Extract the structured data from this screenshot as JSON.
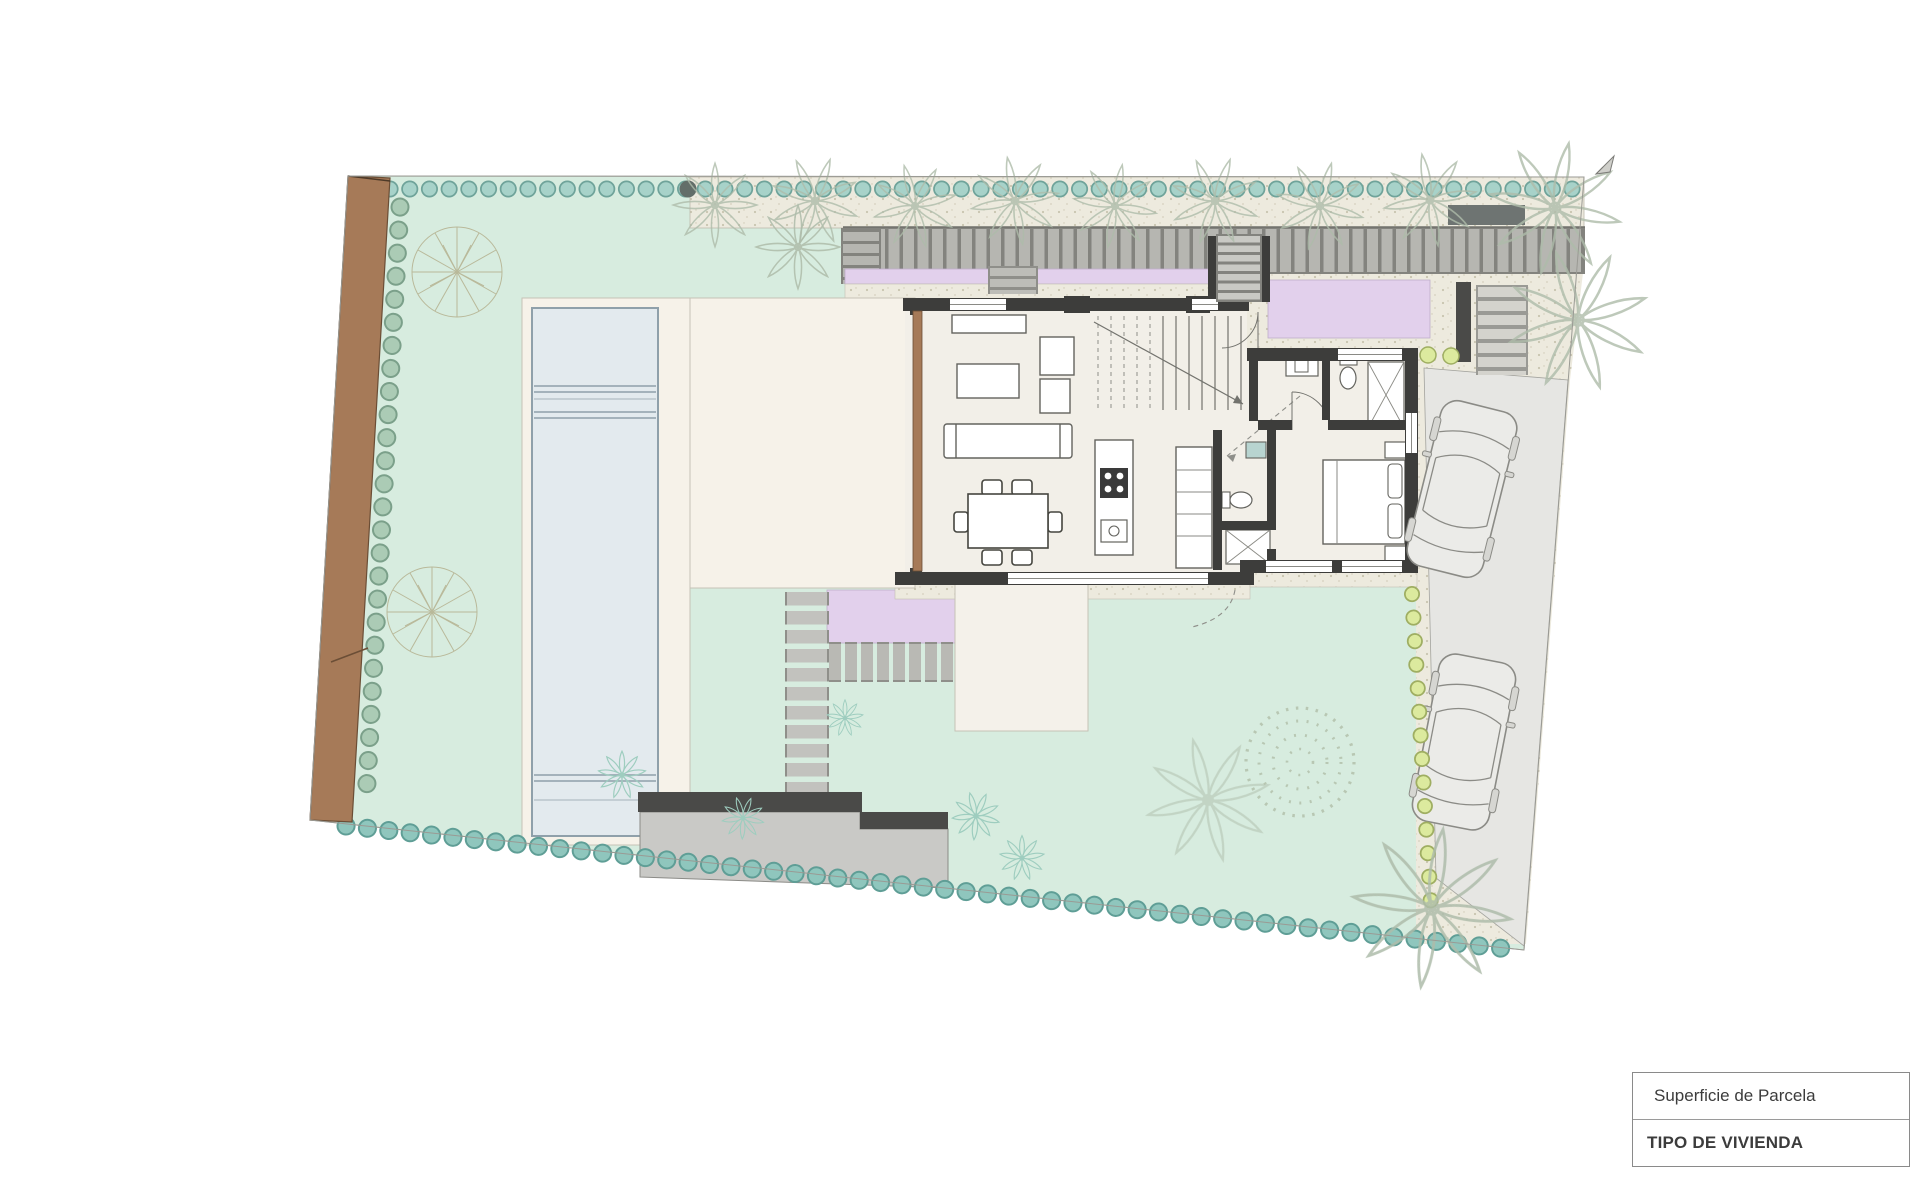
{
  "title_block": {
    "row1": "Superficie de Parcela",
    "row2": "TIPO DE VIVIENDA"
  },
  "colors": {
    "garden_green": "#d7ecdf",
    "pool_water": "#e3eaee",
    "pergola_purple": "#e2d0ec",
    "boundary_brown": "#a67a58",
    "driveway_gray": "#e6e6e3",
    "deck_cream": "#f6f2e9",
    "house_floor": "#f2efe8",
    "wall_dark": "#3d3d3b",
    "hedge_teal_fill": "#9ccac2",
    "hedge_teal_stroke": "#649c93",
    "hedge_lime_fill": "#dcea9e",
    "hedge_lime_stroke": "#9fae62",
    "gravel_beige": "#edeade"
  }
}
